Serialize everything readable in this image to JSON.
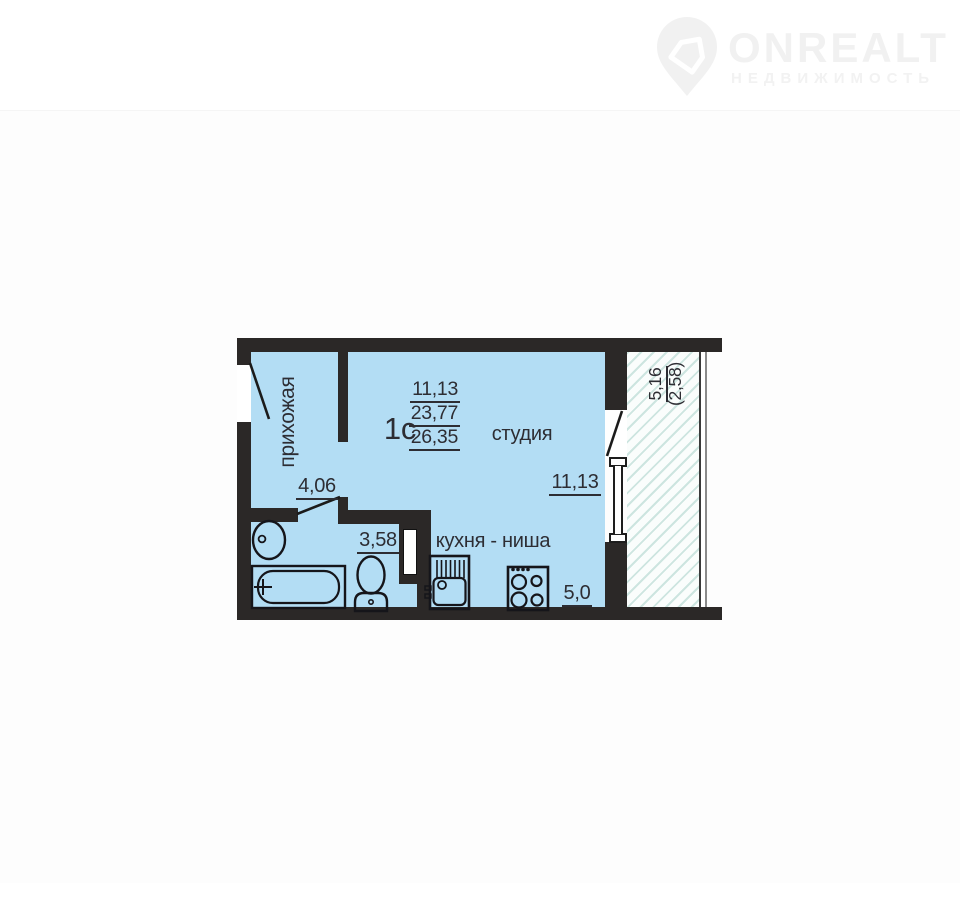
{
  "logo": {
    "brand": "ONREALT",
    "subtitle": "НЕДВИЖИМОСТЬ",
    "color": "#f1f1f1",
    "icon": "house-pin-icon"
  },
  "plan": {
    "apartment": {
      "type_label": "1с",
      "living_area": "11,13",
      "total_area": "23,77",
      "total_area_with_balcony": "26,35"
    },
    "rooms": {
      "hallway": {
        "name": "прихожая",
        "area": "4,06"
      },
      "studio": {
        "name": "студия",
        "area": "11,13"
      },
      "kitchen_niche": {
        "name": "кухня - ниша",
        "area": "5,0"
      },
      "bathroom": {
        "area": "3,58"
      },
      "balcony": {
        "area": "5,16",
        "area_reduced": "(2,58)"
      }
    },
    "fixtures": [
      "washbasin-icon",
      "bathtub-icon",
      "toilet-icon",
      "kitchen-sink-icon",
      "stove-icon"
    ],
    "colors": {
      "floor": "#b3ddf4",
      "wall": "#2b2827",
      "text": "#2d2d33",
      "hatch": "#cde5e0"
    }
  }
}
